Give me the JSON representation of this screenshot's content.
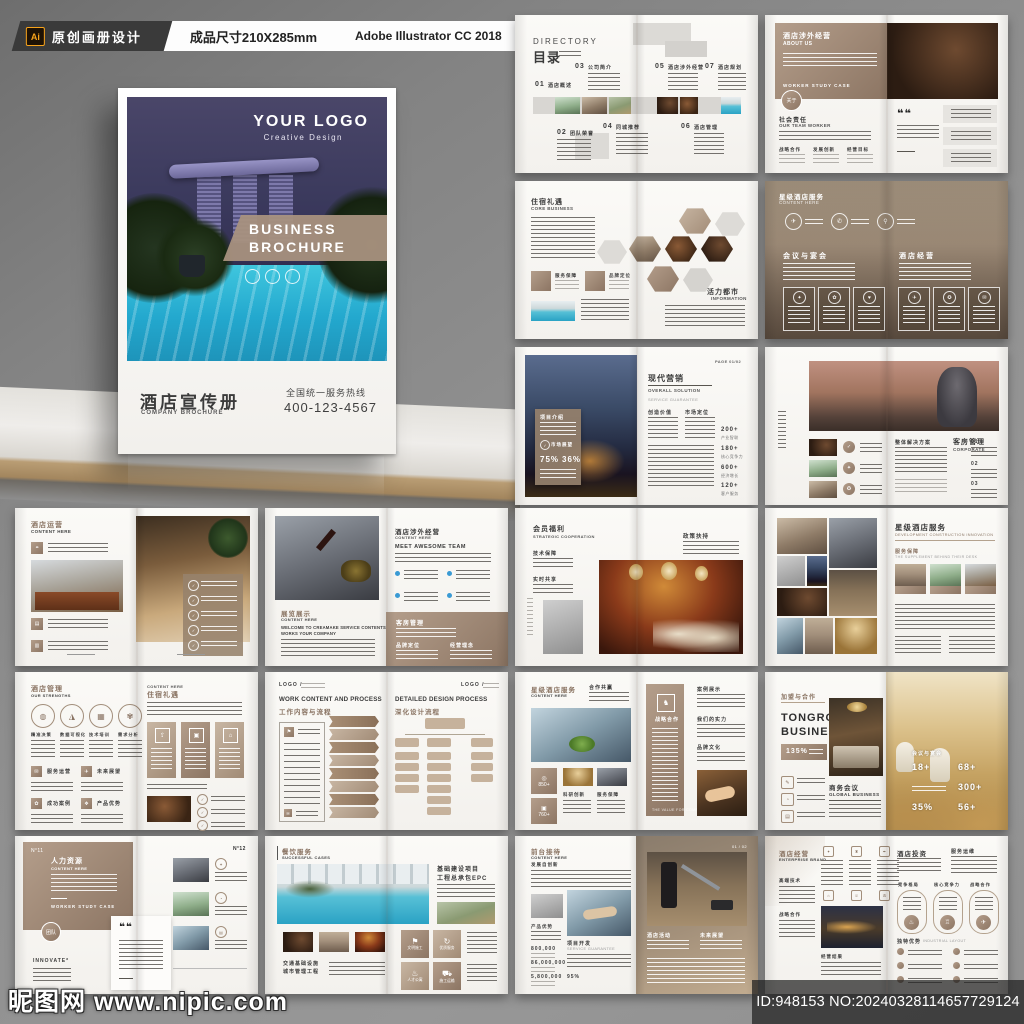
{
  "topbar": {
    "ai_badge": "Ai",
    "badge1": "原创画册设计",
    "badge2": "成品尺寸210X285mm",
    "badge3": "Adobe Illustrator CC 2018"
  },
  "cover": {
    "logo": "YOUR LOGO",
    "logo_sub": "Creative Design",
    "banner1": "BUSINESS",
    "banner2": "BROCHURE",
    "title_cn": "酒店宣传册",
    "title_en": "COMPANY BROCHURE",
    "hotline_label": "全国统一服务热线",
    "hotline": "400-123-4567"
  },
  "watermark": {
    "site": "昵图网 www.nipic.com",
    "id_no": "ID:948153 NO:20240328114657729124"
  },
  "spreads": [
    {
      "en": "DIRECTORY",
      "cn": "目录",
      "items": [
        [
          "01",
          "酒店概述"
        ],
        [
          "02",
          "团队荣誉"
        ],
        [
          "03",
          "公司简介"
        ],
        [
          "04",
          "同城推荐"
        ],
        [
          "05",
          "酒店涉外经营"
        ],
        [
          "06",
          "酒店管理"
        ],
        [
          "07",
          "酒店规划"
        ]
      ]
    },
    {
      "cn": "酒店涉外经营",
      "en": "ABOUT US",
      "tabs": "WORKER      STUDY      CASE",
      "circle": "关于",
      "sec_cn": "社会责任",
      "sec_en": "OUR TEAM WORKER",
      "cols": [
        "战略合作",
        "发展创新",
        "经营目标"
      ],
      "quote": "❝❝"
    },
    {
      "cn": "住宿礼遇",
      "en": "CORE BUSINESS",
      "sq1": "服务保障",
      "sq2": "品牌定位",
      "right_cn": "活力都市",
      "right_en": "INFORMATION"
    },
    {
      "cn": "星级酒店服务",
      "en": "CONTENT HERE",
      "h1": "会议与宴会",
      "h2": "酒店经营"
    },
    {
      "page": "PAGE 01/02",
      "card_cn": "项目介绍",
      "card2": "市场展望",
      "p1": "75%",
      "p2": "36%",
      "cn": "现代营销",
      "en": "OVERALL SOLUTION",
      "sub": "SERVICE GUARANTEE",
      "col1": "创造价值",
      "col2": "市场定位",
      "stats": [
        [
          "200+",
          "产业智联"
        ],
        [
          "180+",
          "核心竞争力"
        ],
        [
          "600+",
          "经济增长"
        ],
        [
          "120+",
          "客户服务"
        ]
      ]
    },
    {
      "head": "整体解决方案",
      "cn": "客房管理",
      "en": "CORPORATE",
      "nums": [
        "01",
        "02",
        "03"
      ]
    },
    {
      "cn": "酒店运营",
      "en": "CONTENT HERE"
    },
    {
      "cn": "展览展示",
      "en": "CONTENT HERE",
      "w1": "WELCOME TO CREAMAKE SERVICE CONTENTS",
      "w2": "WORKS YOUR COMPANY",
      "r_cn": "酒店涉外经营",
      "r_en": "CONTENT HERE",
      "team": "MEET AWESOME TEAM",
      "block_cn": "客房管理",
      "b1": "品牌定位",
      "b2": "经营理念"
    },
    {
      "cn": "会员福利",
      "en": "STRATEGIC COOPERATION",
      "s1": "技术保障",
      "s2": "实时共享",
      "right": "政策扶持"
    },
    {
      "cn": "星级酒店服务",
      "en": "DEVELOPMENT CONSTRUCTION INNOVATION",
      "sub": "服务保障",
      "sub_en": "THE SUPPLEMENT BEHIND THEIR DESK"
    },
    {
      "cn": "酒店管理",
      "en": "OUR STRENGTHS",
      "circles": [
        "精准决策",
        "数据可视化",
        "技术培训",
        "需求分析"
      ],
      "squares": [
        "服务运营",
        "未来展望",
        "成功案例",
        "产品优势"
      ],
      "r_en": "CONTENT HERE",
      "r_cn": "住宿礼遇"
    },
    {
      "l_en": "WORK CONTENT AND PROCESS",
      "l_cn": "工作内容与流程",
      "r_en": "DETAILED DESIGN PROCESS",
      "r_cn": "深化设计流程",
      "logo": "LOGO /"
    },
    {
      "cn": "星级酒店服务",
      "en": "CONTENT HERE",
      "lbl": "合作共赢",
      "n1": "850+",
      "n2": "760+",
      "l1": "科研创新",
      "l2": "服务保障",
      "panel": "战略合作",
      "r1": "案例展示",
      "r2": "我们的实力",
      "r3": "品牌文化"
    },
    {
      "small": "加盟与合作",
      "t1": "TONGRO",
      "t2": "BUSINESS",
      "pct": "135%",
      "m_cn": "商务会议",
      "m_en": "GLOBAL BUSINESS",
      "ov": "会议与宴会",
      "stats": [
        "18+",
        "68+",
        "300+",
        "35%",
        "56+"
      ]
    },
    {
      "n1": "N°11",
      "n2": "N°12",
      "cn": "人力资源",
      "en": "CONTENT HERE",
      "tabs": "WORKER    STUDY    CASE",
      "quote": "❝❝",
      "innov": "INNOVATE*"
    },
    {
      "cn": "餐饮服务",
      "en": "SUCCESSFUL CASES",
      "h1": "基础建设项目",
      "h2": "工程总承包EPC",
      "f1": "交通基础设施",
      "f2": "城市管理工程"
    },
    {
      "cn": "前台接待",
      "en": "CONTENT HERE",
      "sub": "发展自创新",
      "adv": "产品优势",
      "stats": [
        "800,000",
        "86,000,000",
        "5,800,000",
        "95%"
      ],
      "d_cn": "项目开发",
      "d_en": "SERVICE GUARANTEE",
      "r1": "酒店活动",
      "r2": "未来展望",
      "pg": "01 / 02"
    },
    {
      "cn": "酒店经营",
      "en": "ENTERPRISE BRAND",
      "l1": "高端技术",
      "l2": "战略合作",
      "cap": "经营结果",
      "r_cn": "酒店投资",
      "r_sub": "服务运维",
      "circles": [
        "竞争格局",
        "核心竞争力",
        "战略合作"
      ],
      "adv_cn": "独特优势",
      "adv_en": "INDUSTRIAL LAYOUT"
    }
  ]
}
